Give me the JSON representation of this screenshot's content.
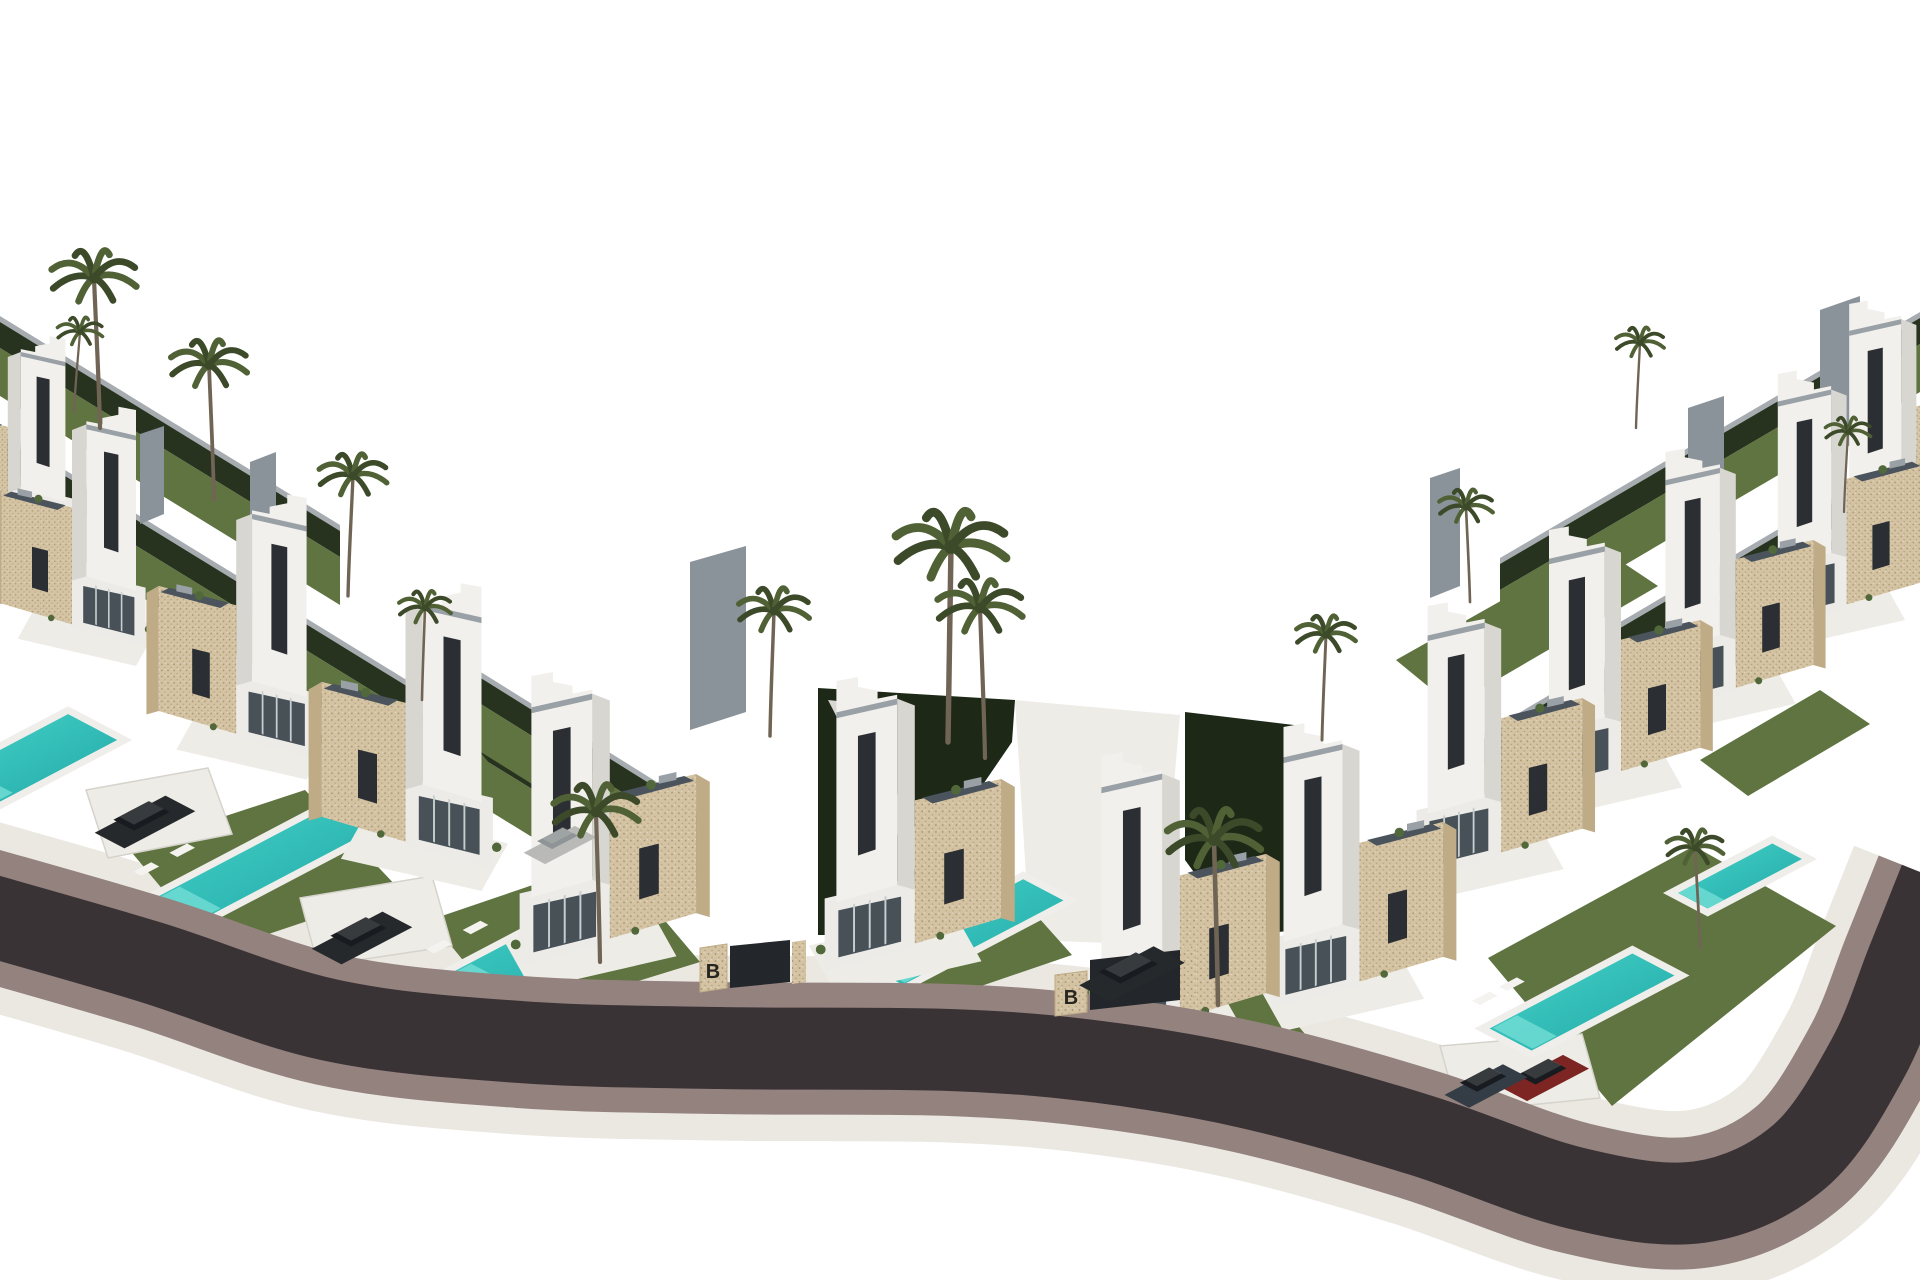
{
  "meta": {
    "alt": "Aerial 3D render of a row of modern white villas with beige stone facades, private turquoise pools, lawns and palm trees along a curved dark road on a white background",
    "width": 1920,
    "height": 1280
  },
  "labels": {
    "gate_emblem": "B"
  },
  "palette": {
    "bg": "#ffffff",
    "asphalt": "#3a3335",
    "curb": "#94827f",
    "wallBand": "#ebe8e2",
    "white1": "#f2f0ec",
    "white2": "#ecebe7",
    "whiteShadow": "#d8d6d1",
    "deck": "#eeece7",
    "deckEdge": "#d6d3cc",
    "roof": "#99a1a7",
    "window": "#2b2f33",
    "glass": "#475157",
    "glassLine": "#c6cfd0",
    "stone": "#d3c3a3",
    "stoneTop": "#e2d5ba",
    "stoneDark": "#bfab86",
    "stoneDot": "#a8906a",
    "solar": "#4b545c",
    "lawn": "#5f7440",
    "hedge": "#27331f",
    "hedgeDark": "#1e2817",
    "fence": "#a7acb1",
    "pool": "#1fa7a4",
    "poolLight": "#6fdcd4",
    "poolBright": "#49d4cc",
    "poolEdge": "#f0eeea",
    "palm": "#3c4a2a",
    "palmLight": "#506135",
    "trunk": "#706455",
    "shrub": "#51683a",
    "carDark": "#26292c",
    "carRed": "#7c2522",
    "carBlue": "#343d46",
    "carLight": "#b9bab8",
    "slab": "#8a929a",
    "pathLight": "#d8d7d2",
    "emblem": "#26251f"
  },
  "scene": {
    "road": {
      "centerline": [
        [
          -30,
          910
        ],
        [
          150,
          962
        ],
        [
          330,
          1020
        ],
        [
          520,
          1042
        ],
        [
          720,
          1048
        ],
        [
          950,
          1050
        ],
        [
          1100,
          1062
        ],
        [
          1250,
          1088
        ],
        [
          1420,
          1135
        ],
        [
          1575,
          1188
        ],
        [
          1700,
          1202
        ],
        [
          1800,
          1156
        ],
        [
          1868,
          1058
        ],
        [
          1908,
          960
        ],
        [
          1940,
          880
        ]
      ],
      "asphalt_w": 82,
      "curb_w": 132,
      "wall_w": 185
    },
    "bands": [
      {
        "from": [
          0,
          322
        ],
        "to": [
          340,
          531
        ]
      },
      {
        "from": [
          0,
          436
        ],
        "to": [
          610,
          811
        ]
      },
      {
        "from": [
          420,
          640
        ],
        "to": [
          700,
          815
        ]
      },
      {
        "from": [
          1920,
          318
        ],
        "to": [
          1500,
          564
        ]
      },
      {
        "from": [
          1920,
          452
        ],
        "to": [
          1610,
          634
        ]
      },
      {
        "from": [
          1790,
          560
        ],
        "to": [
          1430,
          771
        ]
      }
    ],
    "hedges": [
      {
        "pts": [
          [
            818,
            688
          ],
          [
            1015,
            700
          ],
          [
            1012,
            742
          ],
          [
            880,
            935
          ],
          [
            818,
            935
          ]
        ]
      },
      {
        "pts": [
          [
            1185,
            712
          ],
          [
            1302,
            726
          ],
          [
            1302,
            930
          ],
          [
            1240,
            935
          ],
          [
            1185,
            860
          ]
        ]
      }
    ],
    "paths": [
      {
        "pts": [
          [
            828,
            700
          ],
          [
            848,
            702
          ],
          [
            962,
            915
          ],
          [
            940,
            918
          ]
        ],
        "fill": "pathLight"
      },
      {
        "pts": [
          [
            1015,
            700
          ],
          [
            1180,
            715
          ],
          [
            1160,
            945
          ],
          [
            1030,
            940
          ]
        ],
        "fill": "deck"
      }
    ],
    "slabs": [
      {
        "pts": [
          [
            1688,
            408
          ],
          [
            1724,
            396
          ],
          [
            1724,
            530
          ],
          [
            1688,
            544
          ]
        ]
      },
      {
        "pts": [
          [
            1820,
            310
          ],
          [
            1860,
            296
          ],
          [
            1860,
            442
          ],
          [
            1820,
            456
          ]
        ]
      },
      {
        "pts": [
          [
            1430,
            478
          ],
          [
            1460,
            468
          ],
          [
            1460,
            586
          ],
          [
            1430,
            598
          ]
        ]
      },
      {
        "pts": [
          [
            250,
            462
          ],
          [
            276,
            452
          ],
          [
            276,
            580
          ],
          [
            250,
            590
          ]
        ]
      },
      {
        "pts": [
          [
            140,
            434
          ],
          [
            164,
            426
          ],
          [
            164,
            514
          ],
          [
            140,
            524
          ]
        ]
      },
      {
        "pts": [
          [
            690,
            562
          ],
          [
            746,
            546
          ],
          [
            746,
            712
          ],
          [
            690,
            730
          ]
        ]
      }
    ],
    "lawns": [
      {
        "pts": [
          [
            128,
            848
          ],
          [
            305,
            790
          ],
          [
            400,
            890
          ],
          [
            215,
            952
          ]
        ]
      },
      {
        "pts": [
          [
            430,
            920
          ],
          [
            612,
            858
          ],
          [
            700,
            962
          ],
          [
            512,
            1020
          ]
        ]
      },
      {
        "pts": [
          [
            842,
            940
          ],
          [
            1005,
            880
          ],
          [
            1072,
            955
          ],
          [
            905,
            1012
          ]
        ]
      },
      {
        "pts": [
          [
            1046,
            1004
          ],
          [
            1230,
            944
          ],
          [
            1310,
            1040
          ],
          [
            1120,
            1096
          ]
        ]
      },
      {
        "pts": [
          [
            1488,
            958
          ],
          [
            1694,
            846
          ],
          [
            1836,
            926
          ],
          [
            1612,
            1106
          ]
        ]
      },
      {
        "pts": [
          [
            1396,
            660
          ],
          [
            1598,
            546
          ],
          [
            1658,
            586
          ],
          [
            1452,
            706
          ]
        ]
      },
      {
        "pts": [
          [
            1700,
            760
          ],
          [
            1820,
            690
          ],
          [
            1870,
            724
          ],
          [
            1748,
            796
          ]
        ]
      },
      {
        "pts": [
          [
            340,
            780
          ],
          [
            470,
            740
          ],
          [
            520,
            800
          ],
          [
            390,
            845
          ]
        ]
      }
    ],
    "driveways": [
      {
        "pts": [
          [
            86,
            790
          ],
          [
            208,
            768
          ],
          [
            232,
            834
          ],
          [
            108,
            858
          ]
        ]
      },
      {
        "pts": [
          [
            300,
            898
          ],
          [
            432,
            876
          ],
          [
            452,
            946
          ],
          [
            318,
            966
          ]
        ]
      },
      {
        "pts": [
          [
            1440,
            1046
          ],
          [
            1582,
            1034
          ],
          [
            1600,
            1098
          ],
          [
            1458,
            1112
          ]
        ]
      }
    ],
    "pools": [
      {
        "c": [
          30,
          760
        ],
        "l": 150,
        "w": 64,
        "loungers": false
      },
      {
        "c": [
          260,
          866
        ],
        "l": 225,
        "w": 58,
        "loungers": true
      },
      {
        "c": [
          552,
          942
        ],
        "l": 230,
        "w": 56,
        "loungers": true
      },
      {
        "c": [
          963,
          932
        ],
        "l": 190,
        "w": 54,
        "loungers": true
      },
      {
        "c": [
          1582,
          1002
        ],
        "l": 170,
        "w": 56,
        "loungers": true
      },
      {
        "c": [
          1740,
          876
        ],
        "l": 115,
        "w": 42,
        "loungers": false
      }
    ],
    "villas": [
      {
        "x": 15,
        "y": 555,
        "s": 0.72,
        "flip": true
      },
      {
        "x": 80,
        "y": 650,
        "s": 0.8,
        "flip": true
      },
      {
        "x": 245,
        "y": 762,
        "s": 0.88,
        "flip": true
      },
      {
        "x": 415,
        "y": 872,
        "s": 0.95,
        "flip": true
      },
      {
        "x": 600,
        "y": 970,
        "s": 0.98,
        "flip": false
      },
      {
        "x": 905,
        "y": 975,
        "s": 0.98,
        "flip": false
      },
      {
        "x": 1170,
        "y": 1050,
        "s": 0.98,
        "flip": false
      },
      {
        "x": 1350,
        "y": 1012,
        "s": 0.95,
        "flip": false
      },
      {
        "x": 1492,
        "y": 882,
        "s": 0.92,
        "flip": false
      },
      {
        "x": 1612,
        "y": 800,
        "s": 0.9,
        "flip": false
      },
      {
        "x": 1727,
        "y": 716,
        "s": 0.88,
        "flip": false
      },
      {
        "x": 1838,
        "y": 632,
        "s": 0.86,
        "flip": false
      },
      {
        "x": 1908,
        "y": 556,
        "s": 0.84,
        "flip": false
      }
    ],
    "gates": [
      {
        "pillar": [
          [
            700,
            948
          ],
          [
            727,
            944
          ],
          [
            727,
            988
          ],
          [
            700,
            992
          ]
        ],
        "panel": [
          [
            730,
            946
          ],
          [
            790,
            940
          ],
          [
            790,
            982
          ],
          [
            730,
            988
          ]
        ],
        "pillar2": [
          [
            792,
            942
          ],
          [
            806,
            940
          ],
          [
            806,
            982
          ],
          [
            792,
            984
          ]
        ],
        "emblem": [
          713,
          978
        ]
      },
      {
        "pillar": [
          [
            1055,
            975
          ],
          [
            1087,
            971
          ],
          [
            1087,
            1012
          ],
          [
            1055,
            1016
          ]
        ],
        "panel": [
          [
            1090,
            960
          ],
          [
            1180,
            950
          ],
          [
            1180,
            1000
          ],
          [
            1090,
            1010
          ]
        ],
        "pillar2": [
          [
            1182,
            948
          ],
          [
            1196,
            946
          ],
          [
            1196,
            996
          ],
          [
            1182,
            998
          ]
        ],
        "emblem": [
          1071,
          1004
        ]
      }
    ],
    "cars": [
      {
        "c": [
          145,
          822
        ],
        "color": "carDark",
        "l": 80
      },
      {
        "c": [
          362,
          938
        ],
        "color": "carDark",
        "l": 80
      },
      {
        "c": [
          1132,
          974
        ],
        "color": "carDark",
        "l": 84
      },
      {
        "c": [
          1545,
          1078
        ],
        "color": "carRed",
        "l": 70
      },
      {
        "c": [
          1486,
          1086
        ],
        "color": "carBlue",
        "l": 66
      },
      {
        "c": [
          560,
          845
        ],
        "color": "carLight",
        "l": 58
      }
    ],
    "palms": [
      [
        100,
        428,
        150,
        -6
      ],
      [
        74,
        412,
        80,
        6
      ],
      [
        214,
        500,
        135,
        -5
      ],
      [
        348,
        596,
        120,
        5
      ],
      [
        600,
        962,
        150,
        -4
      ],
      [
        948,
        742,
        195,
        3
      ],
      [
        985,
        758,
        150,
        -5
      ],
      [
        770,
        736,
        125,
        4
      ],
      [
        1218,
        1005,
        165,
        -4
      ],
      [
        1322,
        740,
        105,
        4
      ],
      [
        1470,
        602,
        95,
        -4
      ],
      [
        1636,
        428,
        85,
        4
      ],
      [
        1700,
        948,
        100,
        -5
      ],
      [
        1844,
        512,
        80,
        4
      ],
      [
        422,
        700,
        92,
        3
      ]
    ]
  }
}
